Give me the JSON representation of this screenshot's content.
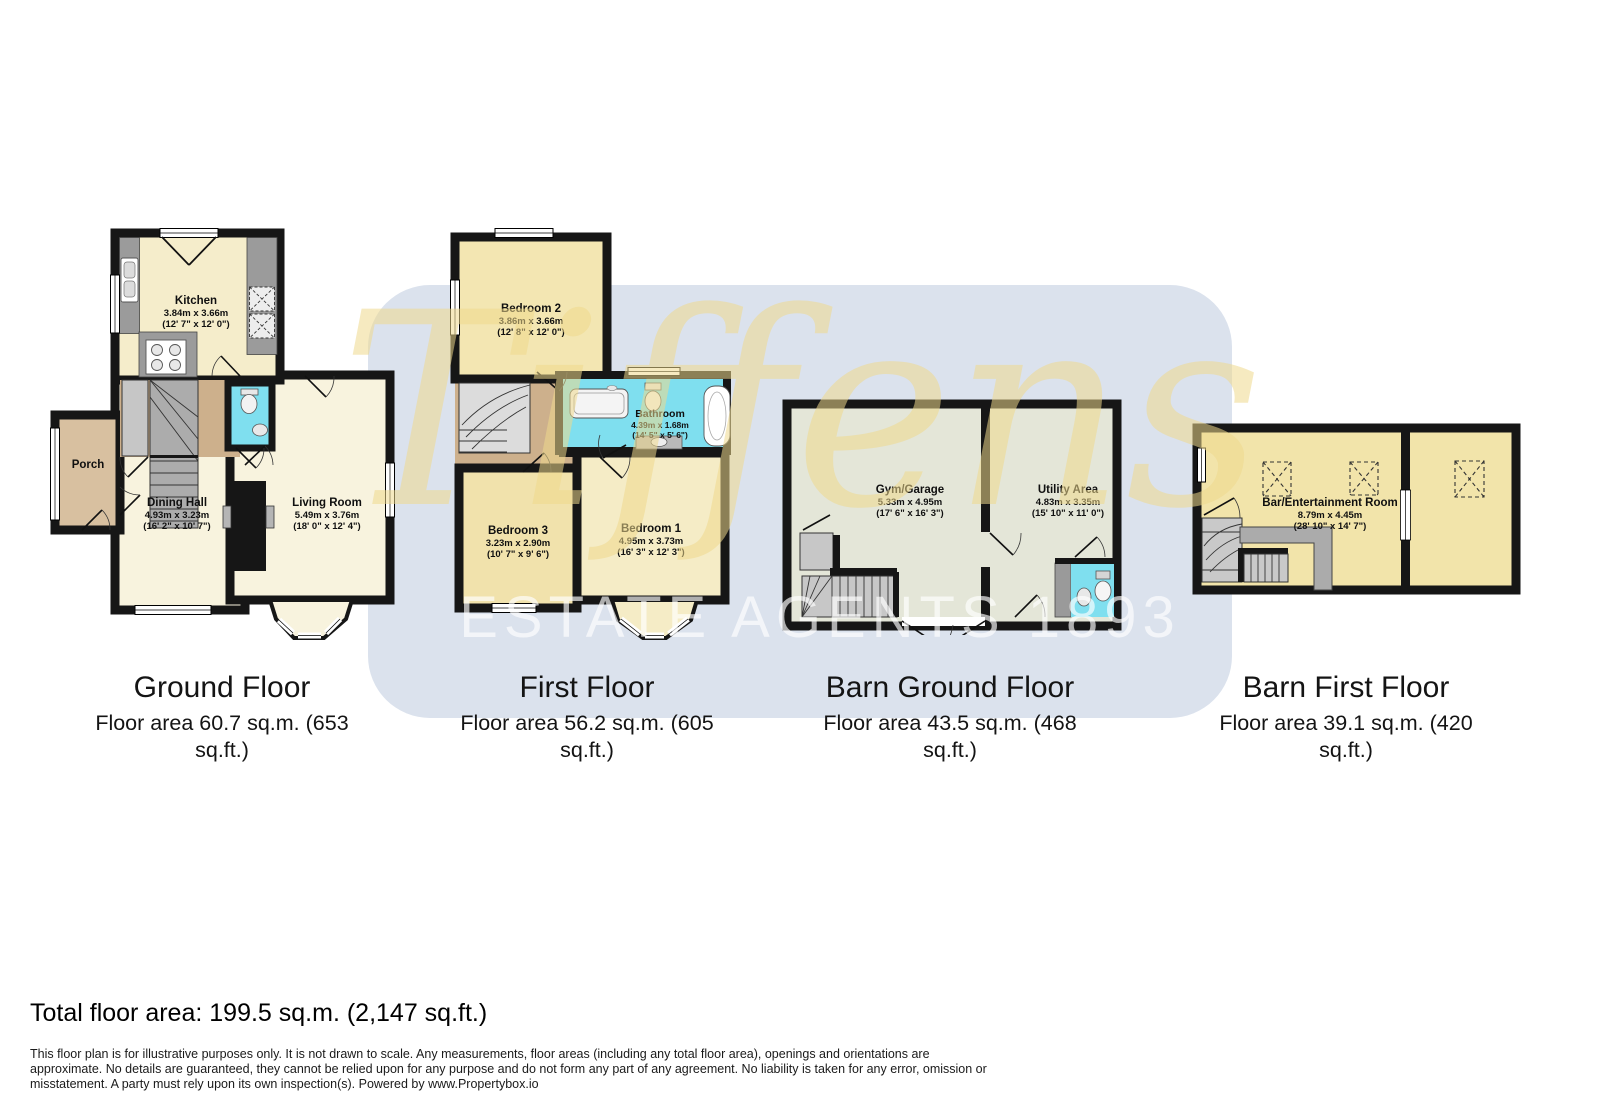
{
  "watermark": {
    "brand": "Tiffens",
    "tagline": "ESTATE AGENTS 1893"
  },
  "plans": [
    {
      "title": "Ground Floor",
      "area_caption": "Floor area 60.7 sq.m. (653 sq.ft.)",
      "rooms": {
        "kitchen": {
          "name": "Kitchen",
          "metric": "3.84m x 3.66m",
          "imperial": "(12' 7\" x 12' 0\")"
        },
        "porch": {
          "name": "Porch"
        },
        "dining": {
          "name": "Dining Hall",
          "metric": "4.93m x 3.23m",
          "imperial": "(16' 2\" x 10' 7\")"
        },
        "living": {
          "name": "Living Room",
          "metric": "5.49m x 3.76m",
          "imperial": "(18' 0\" x 12' 4\")"
        }
      }
    },
    {
      "title": "First Floor",
      "area_caption": "Floor area 56.2 sq.m. (605 sq.ft.)",
      "rooms": {
        "bedroom2": {
          "name": "Bedroom 2",
          "metric": "3.86m x 3.66m",
          "imperial": "(12' 8\" x 12' 0\")"
        },
        "bathroom": {
          "name": "Bathroom",
          "metric": "4.39m x 1.68m",
          "imperial": "(14' 5\" x 5' 6\")"
        },
        "bedroom3": {
          "name": "Bedroom 3",
          "metric": "3.23m x 2.90m",
          "imperial": "(10' 7\" x 9' 6\")"
        },
        "bedroom1": {
          "name": "Bedroom 1",
          "metric": "4.95m x 3.73m",
          "imperial": "(16' 3\" x 12' 3\")"
        }
      }
    },
    {
      "title": "Barn Ground Floor",
      "area_caption": "Floor area 43.5 sq.m. (468 sq.ft.)",
      "rooms": {
        "gym": {
          "name": "Gym/Garage",
          "metric": "5.33m x 4.95m",
          "imperial": "(17' 6\" x 16' 3\")"
        },
        "utility": {
          "name": "Utility Area",
          "metric": "4.83m x 3.35m",
          "imperial": "(15' 10\" x 11' 0\")"
        }
      }
    },
    {
      "title": "Barn First Floor",
      "area_caption": "Floor area 39.1 sq.m. (420 sq.ft.)",
      "rooms": {
        "bar": {
          "name": "Bar/Entertainment Room",
          "metric": "8.79m x 4.45m",
          "imperial": "(28' 10\" x 14' 7\")"
        }
      }
    }
  ],
  "summary": {
    "total": "Total floor area: 199.5 sq.m. (2,147 sq.ft.)"
  },
  "disclaimer_lines": [
    "This floor plan is for illustrative purposes only. It is not drawn to scale. Any measurements, floor areas (including any total floor area), openings and orientations are",
    "approximate. No details are guaranteed, they cannot be relied upon for any purpose and do not form any part of any agreement. No liability is taken for any error, omission or",
    "misstatement. A party must rely upon its own inspection(s). Powered by www.Propertybox.io"
  ],
  "colors": {
    "wall": "#161616",
    "cream_room": "#F8F3DE",
    "yellow_room": "#F2E4AA",
    "sage_room": "#E4E6D8",
    "tan_hall": "#CDB08C",
    "bathroom_cyan": "#7FDFEF",
    "watermark_panel": "#DBE2ED",
    "watermark_brand": "#EDD78C"
  }
}
